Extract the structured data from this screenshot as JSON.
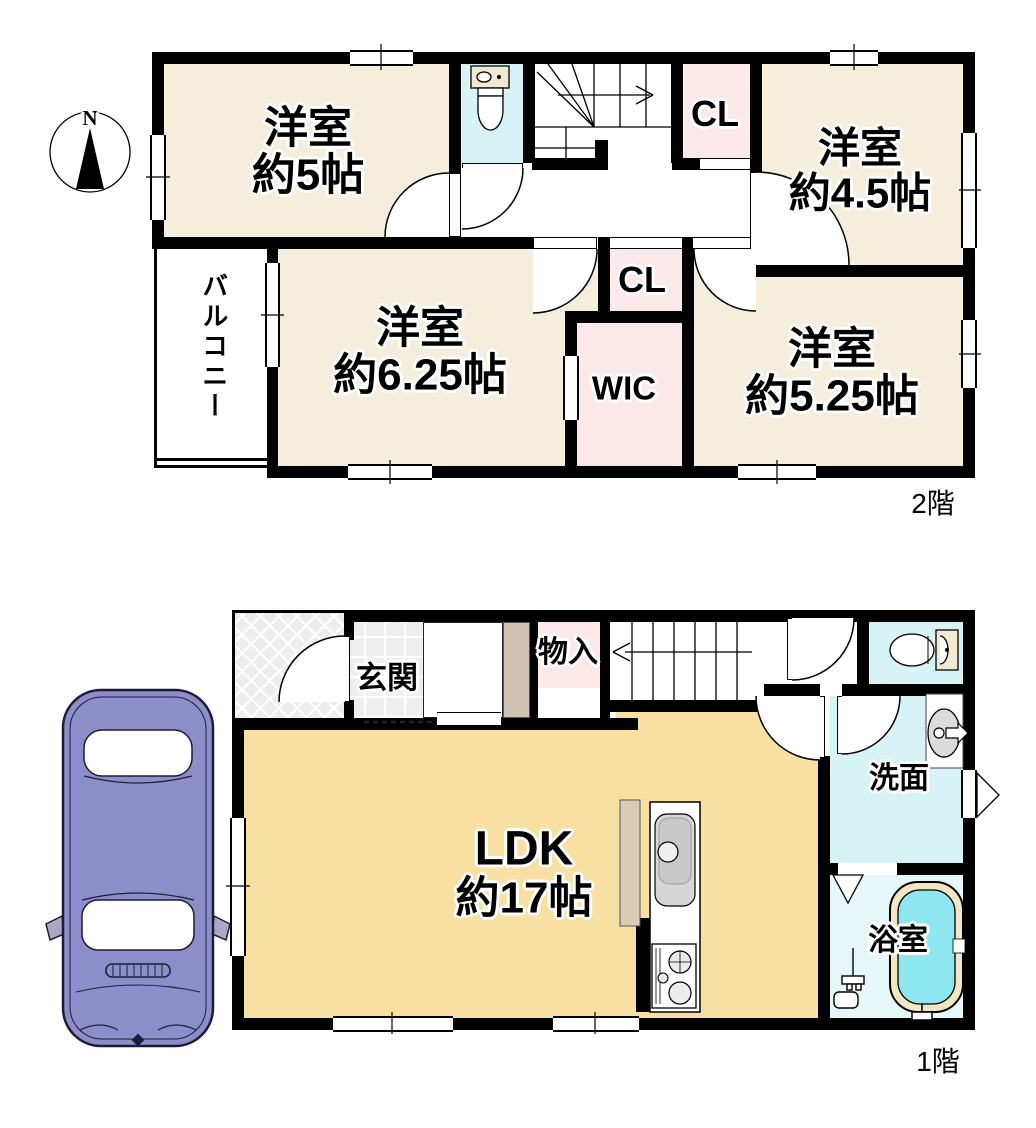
{
  "compass": {
    "north": "N"
  },
  "floor2": {
    "label": "2階",
    "rooms": [
      {
        "name": "western-room-5",
        "line1": "洋室",
        "line2": "約5帖"
      },
      {
        "name": "western-room-4-5",
        "line1": "洋室",
        "line2": "約4.5帖"
      },
      {
        "name": "western-room-6-25",
        "line1": "洋室",
        "line2": "約6.25帖"
      },
      {
        "name": "western-room-5-25",
        "line1": "洋室",
        "line2": "約5.25帖"
      }
    ],
    "closet_upper": "CL",
    "closet_middle": "CL",
    "walk_in_closet": "WIC",
    "balcony": "バルコニー"
  },
  "floor1": {
    "label": "1階",
    "entrance": "玄関",
    "storage": "物入",
    "ldk_line1": "LDK",
    "ldk_line2": "約17帖",
    "washroom": "洗面",
    "bathroom": "浴室"
  },
  "colors": {
    "wall": "#000000",
    "western_room": "#f5eedc",
    "ldk": "#f8dfa2",
    "closet": "#fbe9e9",
    "wet_area": "#d8f3f6",
    "bath_floor": "#e6f7f9",
    "bathtub_water": "#8ee6f0",
    "bathtub_rim": "#f1e7c2",
    "car_body": "#8d8dca"
  }
}
